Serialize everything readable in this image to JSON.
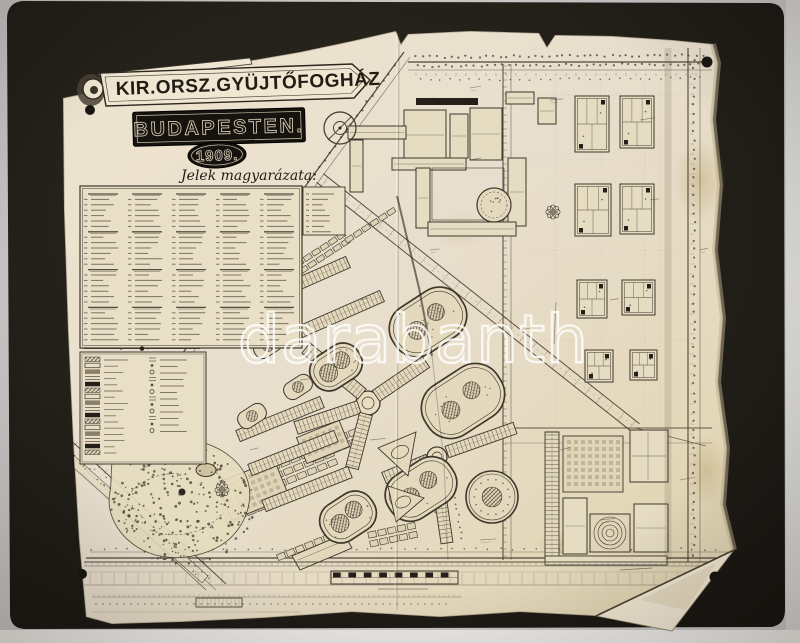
{
  "header": {
    "line1": "KIR.ORSZ.GYÜJTŐFOGHÁZ",
    "line2": "BUDAPESTEN.",
    "year": "1909."
  },
  "legend": {
    "title": "Jelek magyarázata:",
    "items_legible": false
  },
  "watermark": {
    "text": "darabanth"
  },
  "colors": {
    "scan_background": "#c7c6c4",
    "scan_edge": "#d6d5d2",
    "scan_bottom": "#edebe7",
    "mount": "#221f19",
    "paper": "#e9dfc7",
    "paper_light": "#efe7d2",
    "ink": "#3e372c",
    "ink_dark": "#241f18",
    "plate": "#16120d",
    "plate_letters": "#d8cfb8",
    "watermark": "#ffffff"
  }
}
